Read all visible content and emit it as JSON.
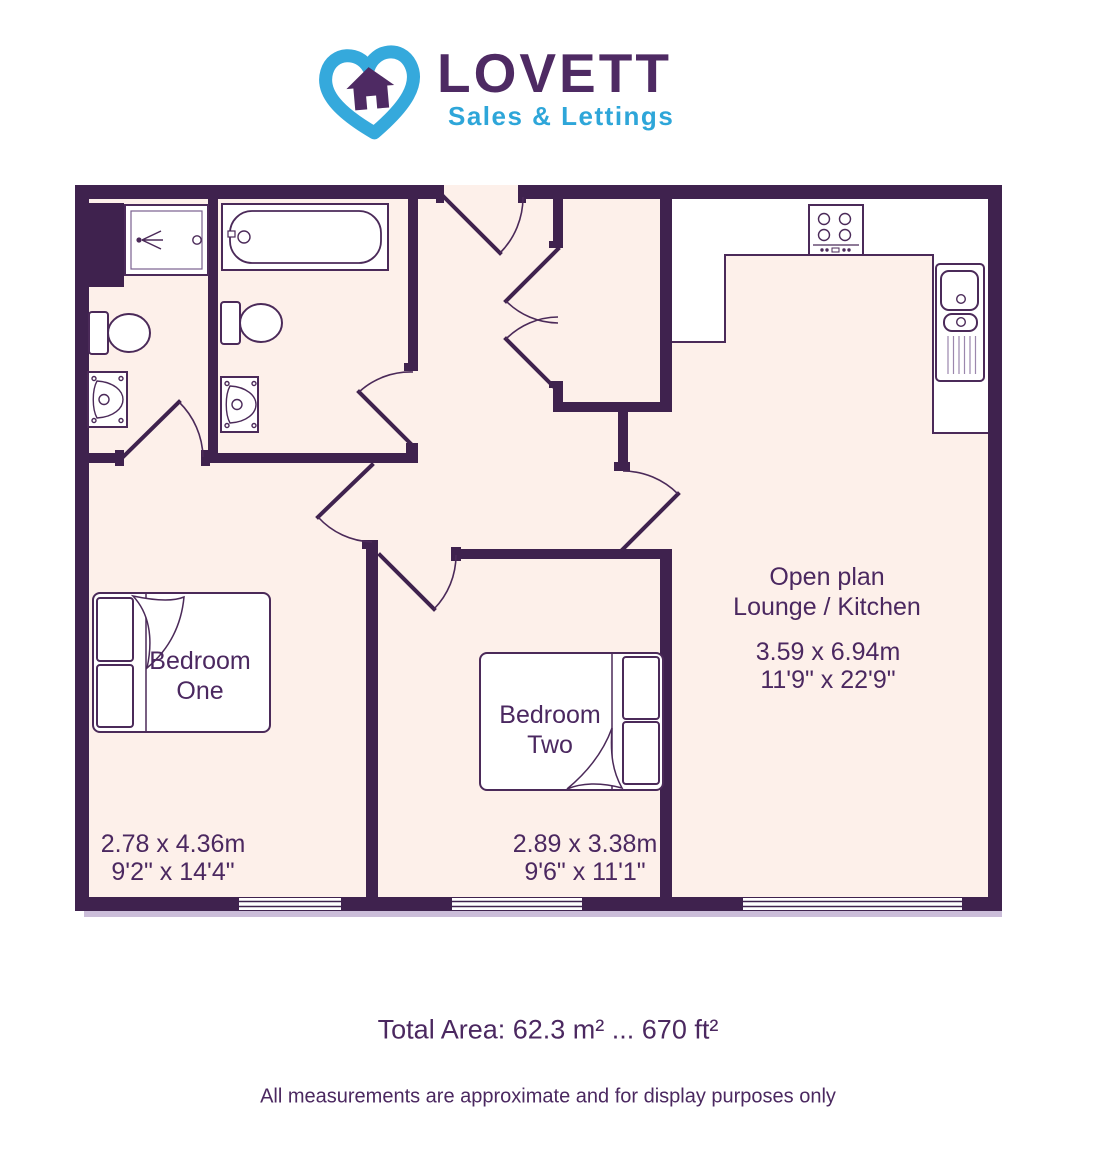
{
  "logo": {
    "brand": "LOVETT",
    "tagline": "Sales & Lettings"
  },
  "brand_colors": {
    "blue": "#2ea6d9",
    "purple": "#4e2a63"
  },
  "floorplan": {
    "rooms": [
      {
        "id": "bedroom-one",
        "label_line1": "Bedroom",
        "label_line2": "One",
        "size_metric": "2.78 x 4.36m",
        "size_imperial": "9'2\" x 14'4\""
      },
      {
        "id": "bedroom-two",
        "label_line1": "Bedroom",
        "label_line2": "Two",
        "size_metric": "2.89 x 3.38m",
        "size_imperial": "9'6\" x 11'1\""
      },
      {
        "id": "open-plan-lounge-kitchen",
        "label_line1": "Open plan",
        "label_line2": "Lounge / Kitchen",
        "size_metric": "3.59 x 6.94m",
        "size_imperial": "11'9\" x 22'9\""
      }
    ],
    "fixtures": [
      "shower",
      "bath",
      "toilet",
      "toilet",
      "wash-basin",
      "wash-basin",
      "hob",
      "kitchen-sink-drainer",
      "kitchen-counter",
      "double-bed",
      "double-bed"
    ],
    "doors": [
      "entrance-door",
      "ensuite-door",
      "bathroom-door",
      "bedroom-one-door",
      "bedroom-two-door",
      "store-double-doors",
      "lounge-door"
    ],
    "window_count": 3,
    "colors": {
      "wall": "#3f224e",
      "floor": "#fdf0ea",
      "fixture_stroke": "#4b2a59",
      "text": "#4b2860",
      "shadow": "#cbbdd9"
    }
  },
  "footer": {
    "total_area": "Total Area: 62.3 m² ... 670 ft²",
    "disclaimer": "All measurements are approximate and for display purposes only"
  }
}
